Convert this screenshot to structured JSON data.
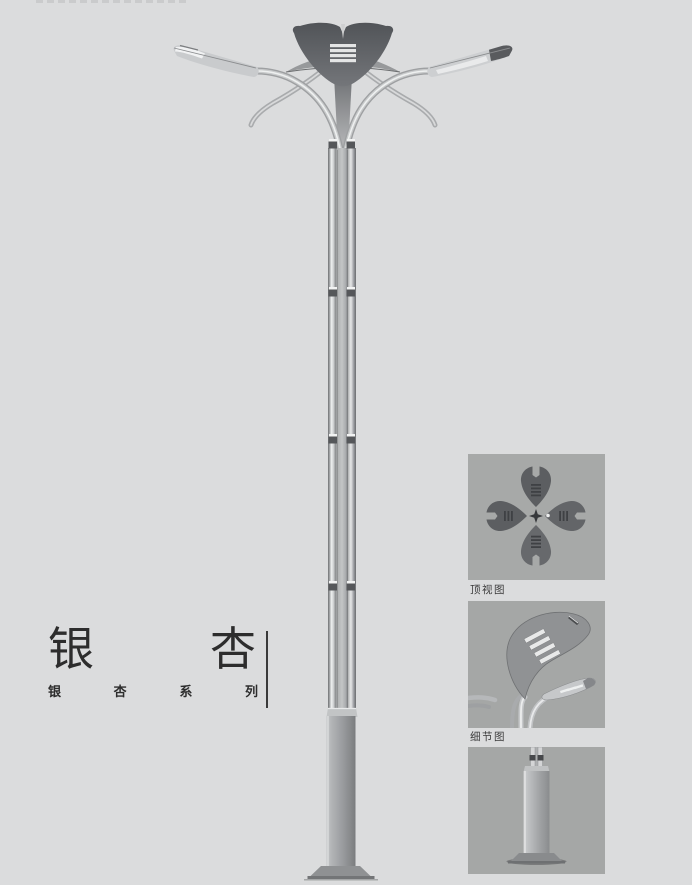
{
  "page": {
    "background_color": "#dbdcdd"
  },
  "branding": {
    "title_chars": [
      "银",
      "杏"
    ],
    "subtitle_chars": [
      "银",
      "杏",
      "系",
      "列"
    ],
    "text_color": "#2d2d2d"
  },
  "thumbnails": {
    "items": [
      {
        "id": "top-view",
        "label": "顶视图"
      },
      {
        "id": "detail-view",
        "label": "细节图"
      },
      {
        "id": "base-view",
        "label": ""
      }
    ],
    "background_color": "#a6a8a7"
  },
  "illustration": {
    "subject": "ginkgo-street-lamp",
    "colors": {
      "crown_dark": "#5c5e61",
      "pole_highlight": "#eef0f0",
      "pole_edge": "#6e7072",
      "base_gray": "#9a9c9f",
      "plate_gray": "#8f9193"
    }
  }
}
